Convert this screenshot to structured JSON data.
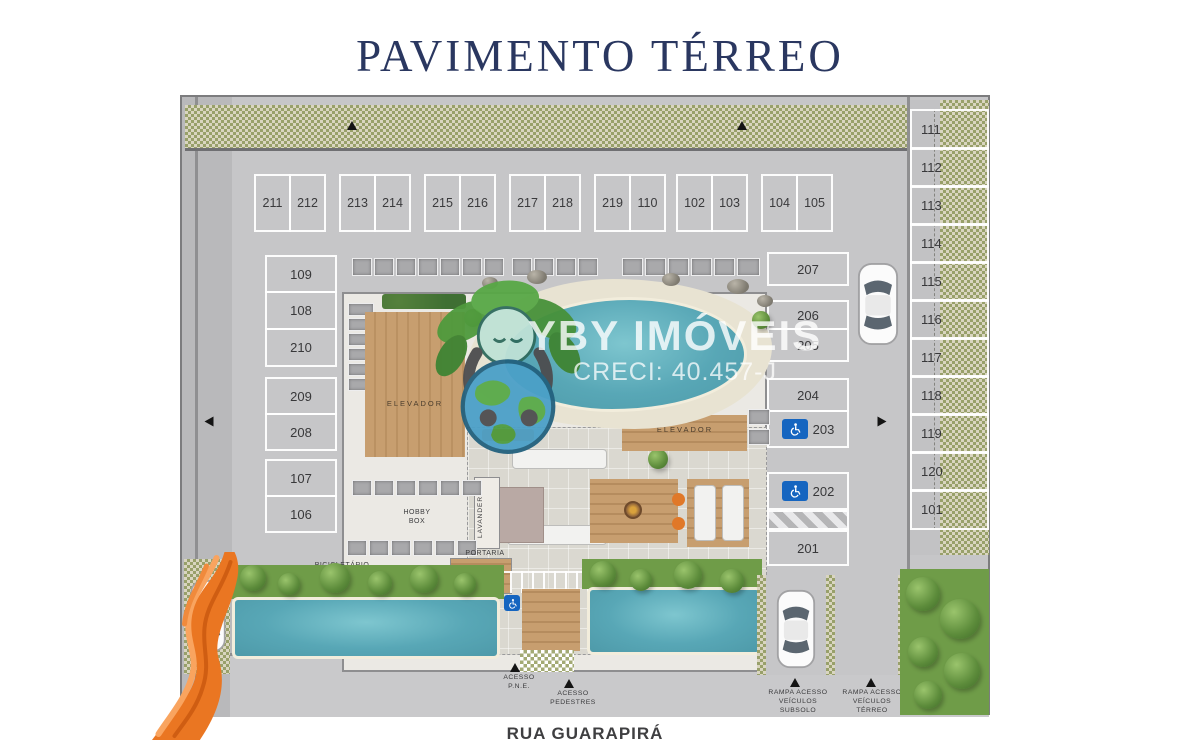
{
  "title": "PAVIMENTO TÉRREO",
  "street": "RUA GUARAPIRÁ",
  "watermark": {
    "brand": "YBY IMÓVEIS",
    "creci": "CRECI: 40.457-J"
  },
  "parking": {
    "top_pairs": [
      [
        "211",
        "212"
      ],
      [
        "213",
        "214"
      ],
      [
        "215",
        "216"
      ],
      [
        "217",
        "218"
      ],
      [
        "219",
        "110"
      ],
      [
        "102",
        "103"
      ],
      [
        "104",
        "105"
      ]
    ],
    "left_column": [
      "109",
      "108",
      "210",
      "209",
      "208",
      "107",
      "106"
    ],
    "inner_right": [
      "207",
      "206",
      "205",
      "204",
      "203",
      "202",
      "201"
    ],
    "right_column": [
      "111",
      "112",
      "113",
      "114",
      "115",
      "116",
      "117",
      "118",
      "119",
      "120",
      "101"
    ],
    "accessible_spots": [
      "203",
      "202"
    ]
  },
  "labels": {
    "hobby_box": "HOBBY BOX",
    "hobby": "HOBBY",
    "box": "BOX",
    "elevador": "ELEVADOR",
    "lavanderia": "LAVANDERIA",
    "portaria": "PORTARIA",
    "bicicletario": "BICICLETÁRIO",
    "acesso": "ACESSO",
    "pne": "P.N.E.",
    "pedestres": "PEDESTRES",
    "rampa_acesso": "RAMPA ACESSO",
    "veiculos": "VEÍCULOS",
    "subsolo": "SUBSOLO",
    "terreo": "TÉRREO"
  },
  "colors": {
    "title_navy": "#2a3760",
    "pool_teal": "#58a7b6",
    "hatch_green": "#98a06a",
    "accessible_blue": "#1565c0",
    "drape_orange": "#ea7622"
  }
}
